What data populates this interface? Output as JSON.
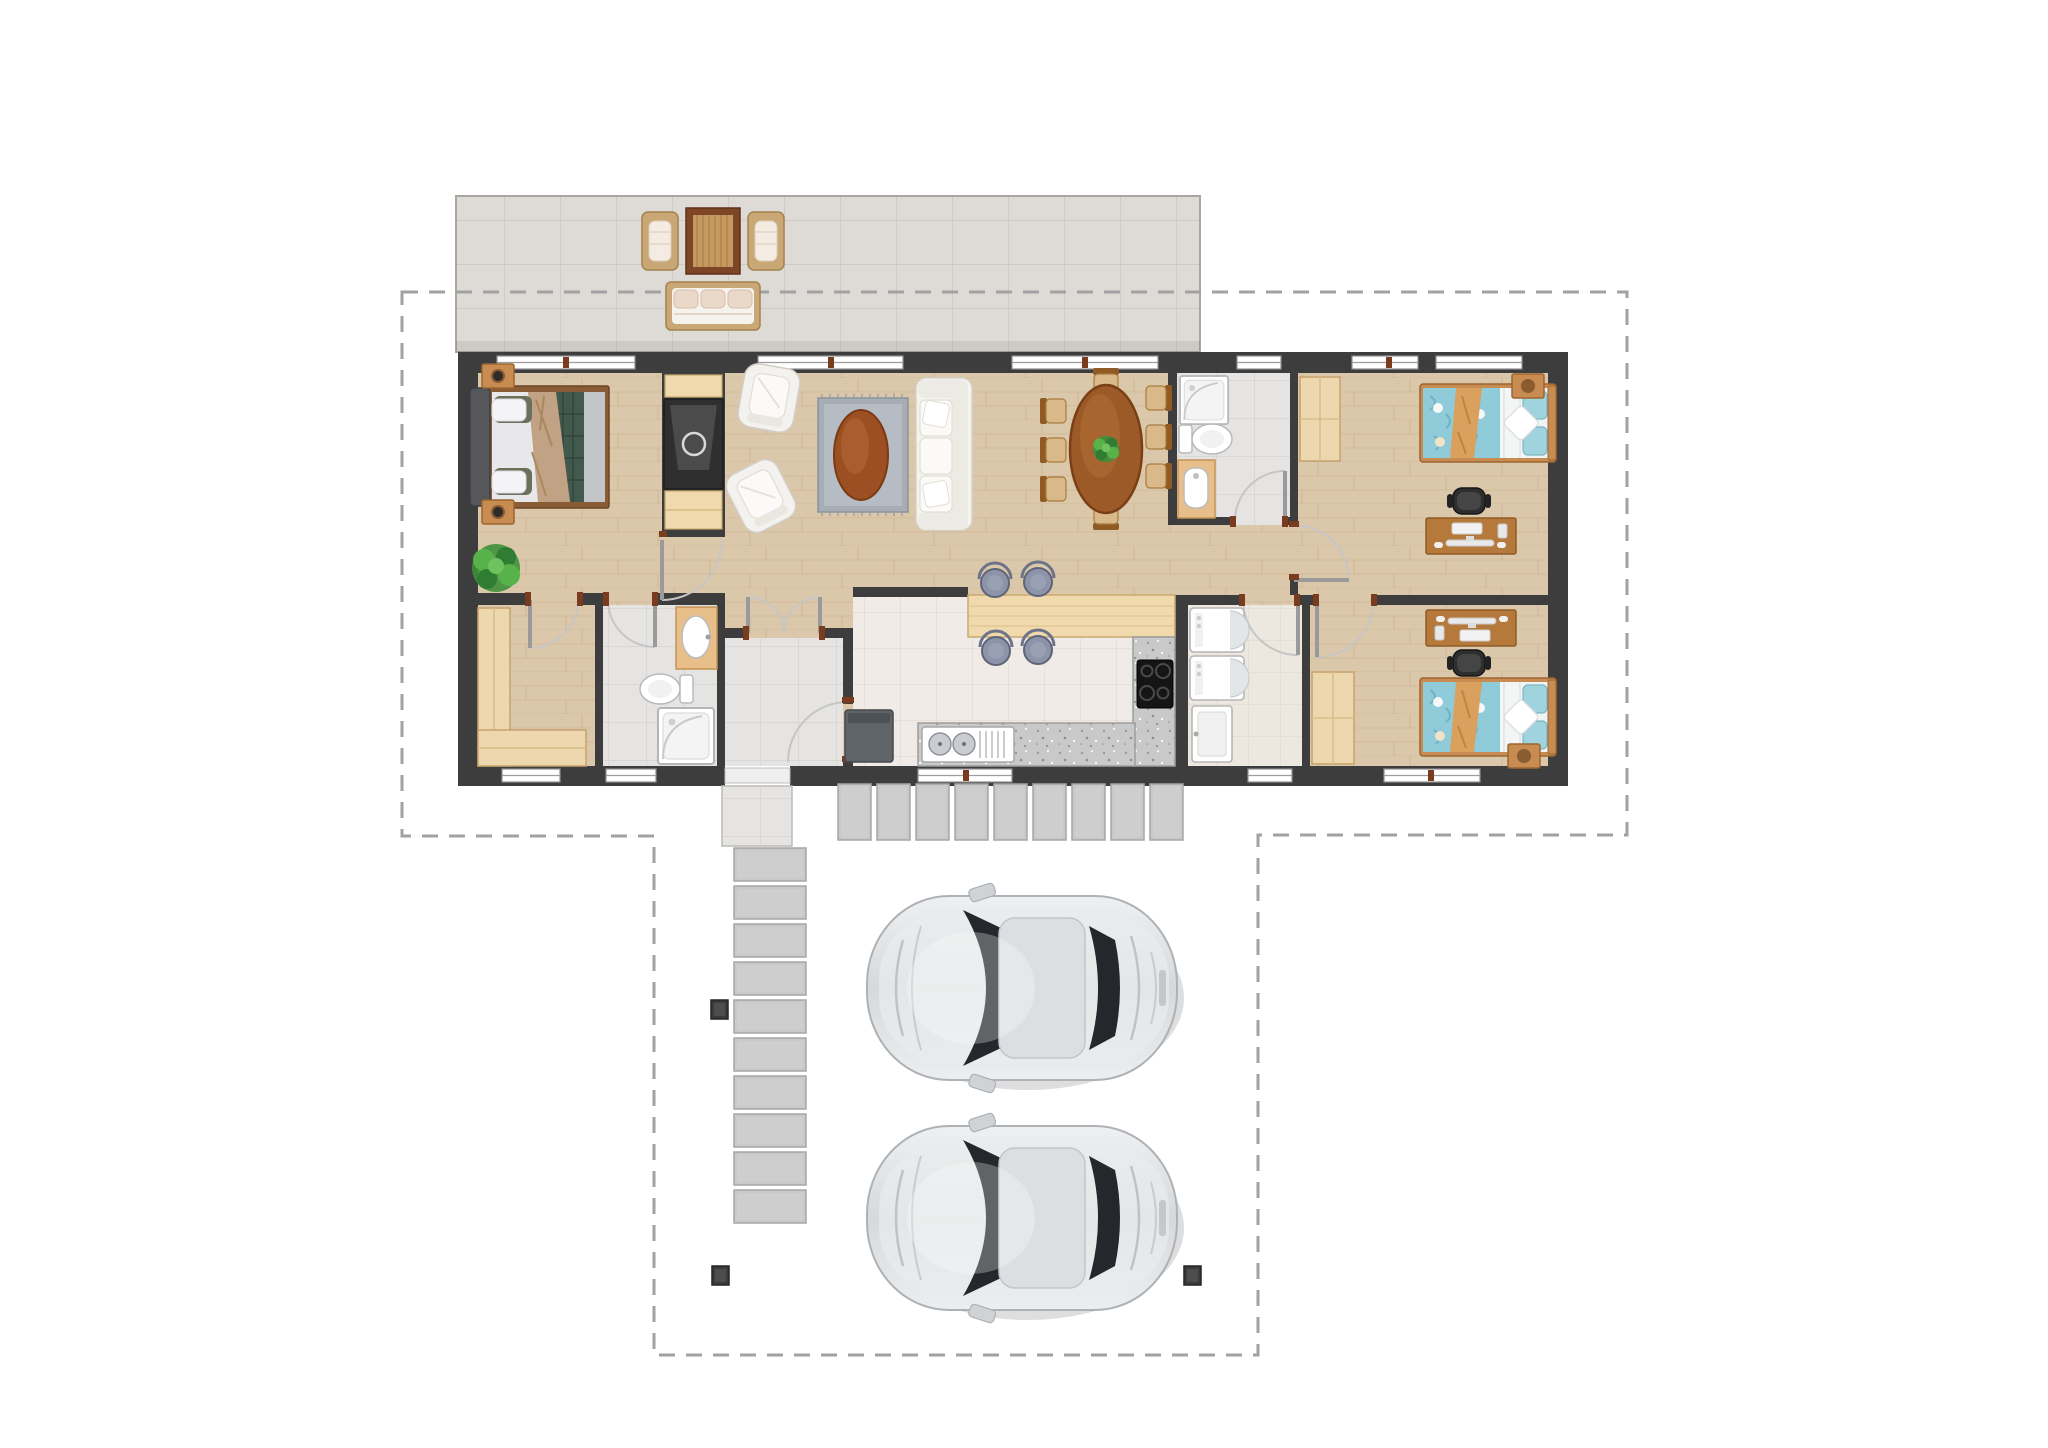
{
  "page": {
    "kind": "architectural floor plan, top-down render, no text labels",
    "background": "#ffffff"
  },
  "palette": {
    "wall": "#3d3d3d",
    "boundary_dash": "#a2a2a2",
    "wood_floor": "#dbc8ab",
    "gray_tile": "#e6e4e2",
    "kitchen_tile": "#f1ebe7",
    "laundry_tile": "#ece7df",
    "patio_tile": "#dedbd7",
    "wardrobe_wood": "#ecd7ae",
    "furniture_wood": "#b5793c",
    "bar_wood": "#f0d9ad",
    "granite": "#c9c9c9",
    "bed_blue": "#8fcbd8",
    "bed_teal": "#42594e",
    "throw_tan": "#d9a05e",
    "upholstery_white": "#f4f2ee",
    "stool_blue_gray": "#8d93a8",
    "car_silver": "#dde0e2",
    "car_glass": "#24272b",
    "door_jamb_brown": "#7a3c1e",
    "plant_green": "#4aa344"
  },
  "site": {
    "property_boundary": {
      "style": "dashed polygon around lot and carport",
      "color": "#a2a2a2"
    },
    "patio": {
      "floor": "gray ceramic tile",
      "furniture": [
        {
          "item": "wicker-armchair",
          "cushion": "blush-white"
        },
        {
          "item": "outdoor-rug",
          "color": "brown-tan"
        },
        {
          "item": "wicker-armchair",
          "cushion": "blush-white"
        },
        {
          "item": "wicker-sofa",
          "cushions": 3
        }
      ]
    },
    "walkways": {
      "paver_walkway_below_kitchen_tiles": 9,
      "paver_path_to_entry_tiles": 10,
      "entry_porch": "gray tile",
      "carport_posts": 4
    },
    "vehicles": {
      "count": 2,
      "type": "sedan, top view",
      "color": "silver",
      "facing": "left"
    }
  },
  "house": {
    "stories": 1,
    "rooms": [
      {
        "name": "master-bedroom",
        "floor": "wood",
        "furniture": [
          "double-bed-teal-tan",
          "nightstand-with-lamp",
          "nightstand-with-lamp",
          "potted-plant"
        ]
      },
      {
        "name": "walk-in-closet",
        "floor": "wood",
        "furniture": [
          "l-shaped-wardrobe"
        ]
      },
      {
        "name": "bathroom-1",
        "floor": "gray tile",
        "fixtures": [
          "wood-vanity-sink",
          "toilet",
          "shower"
        ]
      },
      {
        "name": "entry-vestibule",
        "floor": "gray tile",
        "features": [
          "double-french-door",
          "entry-opening-to-porch",
          "door-to-kitchen"
        ]
      },
      {
        "name": "living-room",
        "floor": "wood",
        "furniture": [
          "tv-fireplace-wall-unit",
          "armchair",
          "armchair",
          "gray-area-rug",
          "oval-coffee-table",
          "white-sofa"
        ]
      },
      {
        "name": "dining-room",
        "floor": "wood",
        "furniture": [
          "oval-dining-table",
          "dining-chairs x8",
          "centerpiece-plant"
        ]
      },
      {
        "name": "kitchen",
        "floor": "light tile",
        "fixtures": [
          "breakfast-bar",
          "bar-stools x4",
          "l-shaped-granite-counter",
          "double-bowl-sink",
          "cooktop-4-burner",
          "trash-bin"
        ]
      },
      {
        "name": "bathroom-2",
        "floor": "gray tile",
        "fixtures": [
          "shower",
          "toilet",
          "bidet-on-wood-vanity"
        ]
      },
      {
        "name": "laundry-room",
        "floor": "beige tile",
        "fixtures": [
          "washer",
          "dryer",
          "laundry-sink"
        ]
      },
      {
        "name": "bedroom-1",
        "floor": "wood",
        "furniture": [
          "single-bed-blue",
          "nightstand",
          "wardrobe",
          "desk-with-monitor",
          "office-chair"
        ]
      },
      {
        "name": "bedroom-2",
        "floor": "wood",
        "furniture": [
          "single-bed-blue",
          "nightstand",
          "wardrobe",
          "desk-with-monitor",
          "office-chair"
        ]
      },
      {
        "name": "hallway",
        "floor": "wood"
      }
    ],
    "window_count": 11,
    "interior_door_count": 9
  }
}
